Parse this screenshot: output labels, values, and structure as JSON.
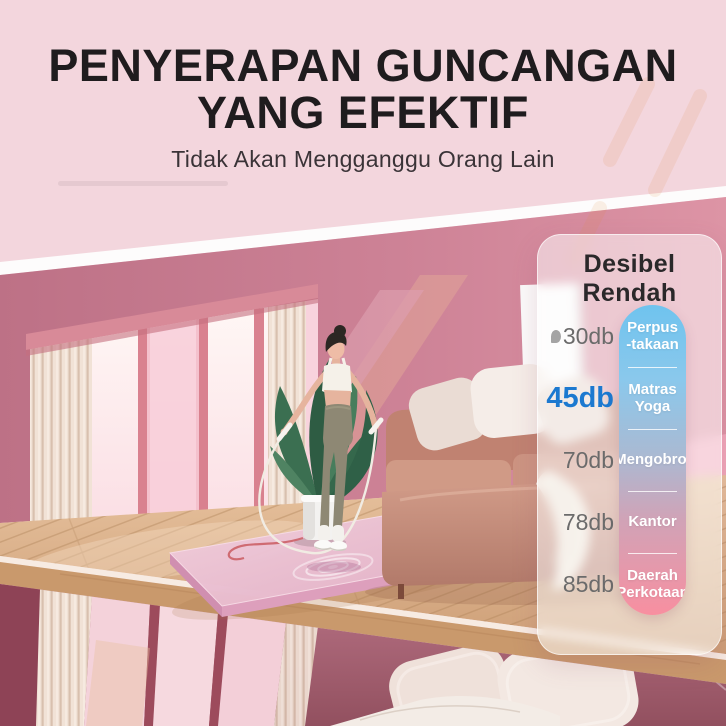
{
  "header": {
    "title_line1": "PENYERAPAN GUNCANGAN",
    "title_line2": "YANG EFEKTIF",
    "subtitle": "Tidak Akan Mengganggu Orang Lain"
  },
  "decibel_panel": {
    "title": "Desibel Rendah",
    "rows": [
      {
        "db": "30db",
        "label_line1": "Perpus",
        "label_line2": "-takaan",
        "highlighted": false
      },
      {
        "db": "45db",
        "label_line1": "Matras",
        "label_line2": "Yoga",
        "highlighted": true
      },
      {
        "db": "70db",
        "label_line1": "Mengobrol",
        "label_line2": "",
        "highlighted": false
      },
      {
        "db": "78db",
        "label_line1": "Kantor",
        "label_line2": "",
        "highlighted": false
      },
      {
        "db": "85db",
        "label_line1": "Daerah",
        "label_line2": "Perkotaan",
        "highlighted": false
      }
    ]
  },
  "icons": {
    "library_marker": "gray-leaf-blob"
  },
  "colors": {
    "header_bg": "#f2d4db",
    "back_wall": "#cd8296",
    "floor_wood": "#d8ab80",
    "mat_pink": "#e9bcd0",
    "accent_blue": "#1c79d0",
    "pill_gradient_top": "#6fc3ee",
    "pill_gradient_bottom": "#f88fa0",
    "lower_room_wall": "#a55f70"
  }
}
